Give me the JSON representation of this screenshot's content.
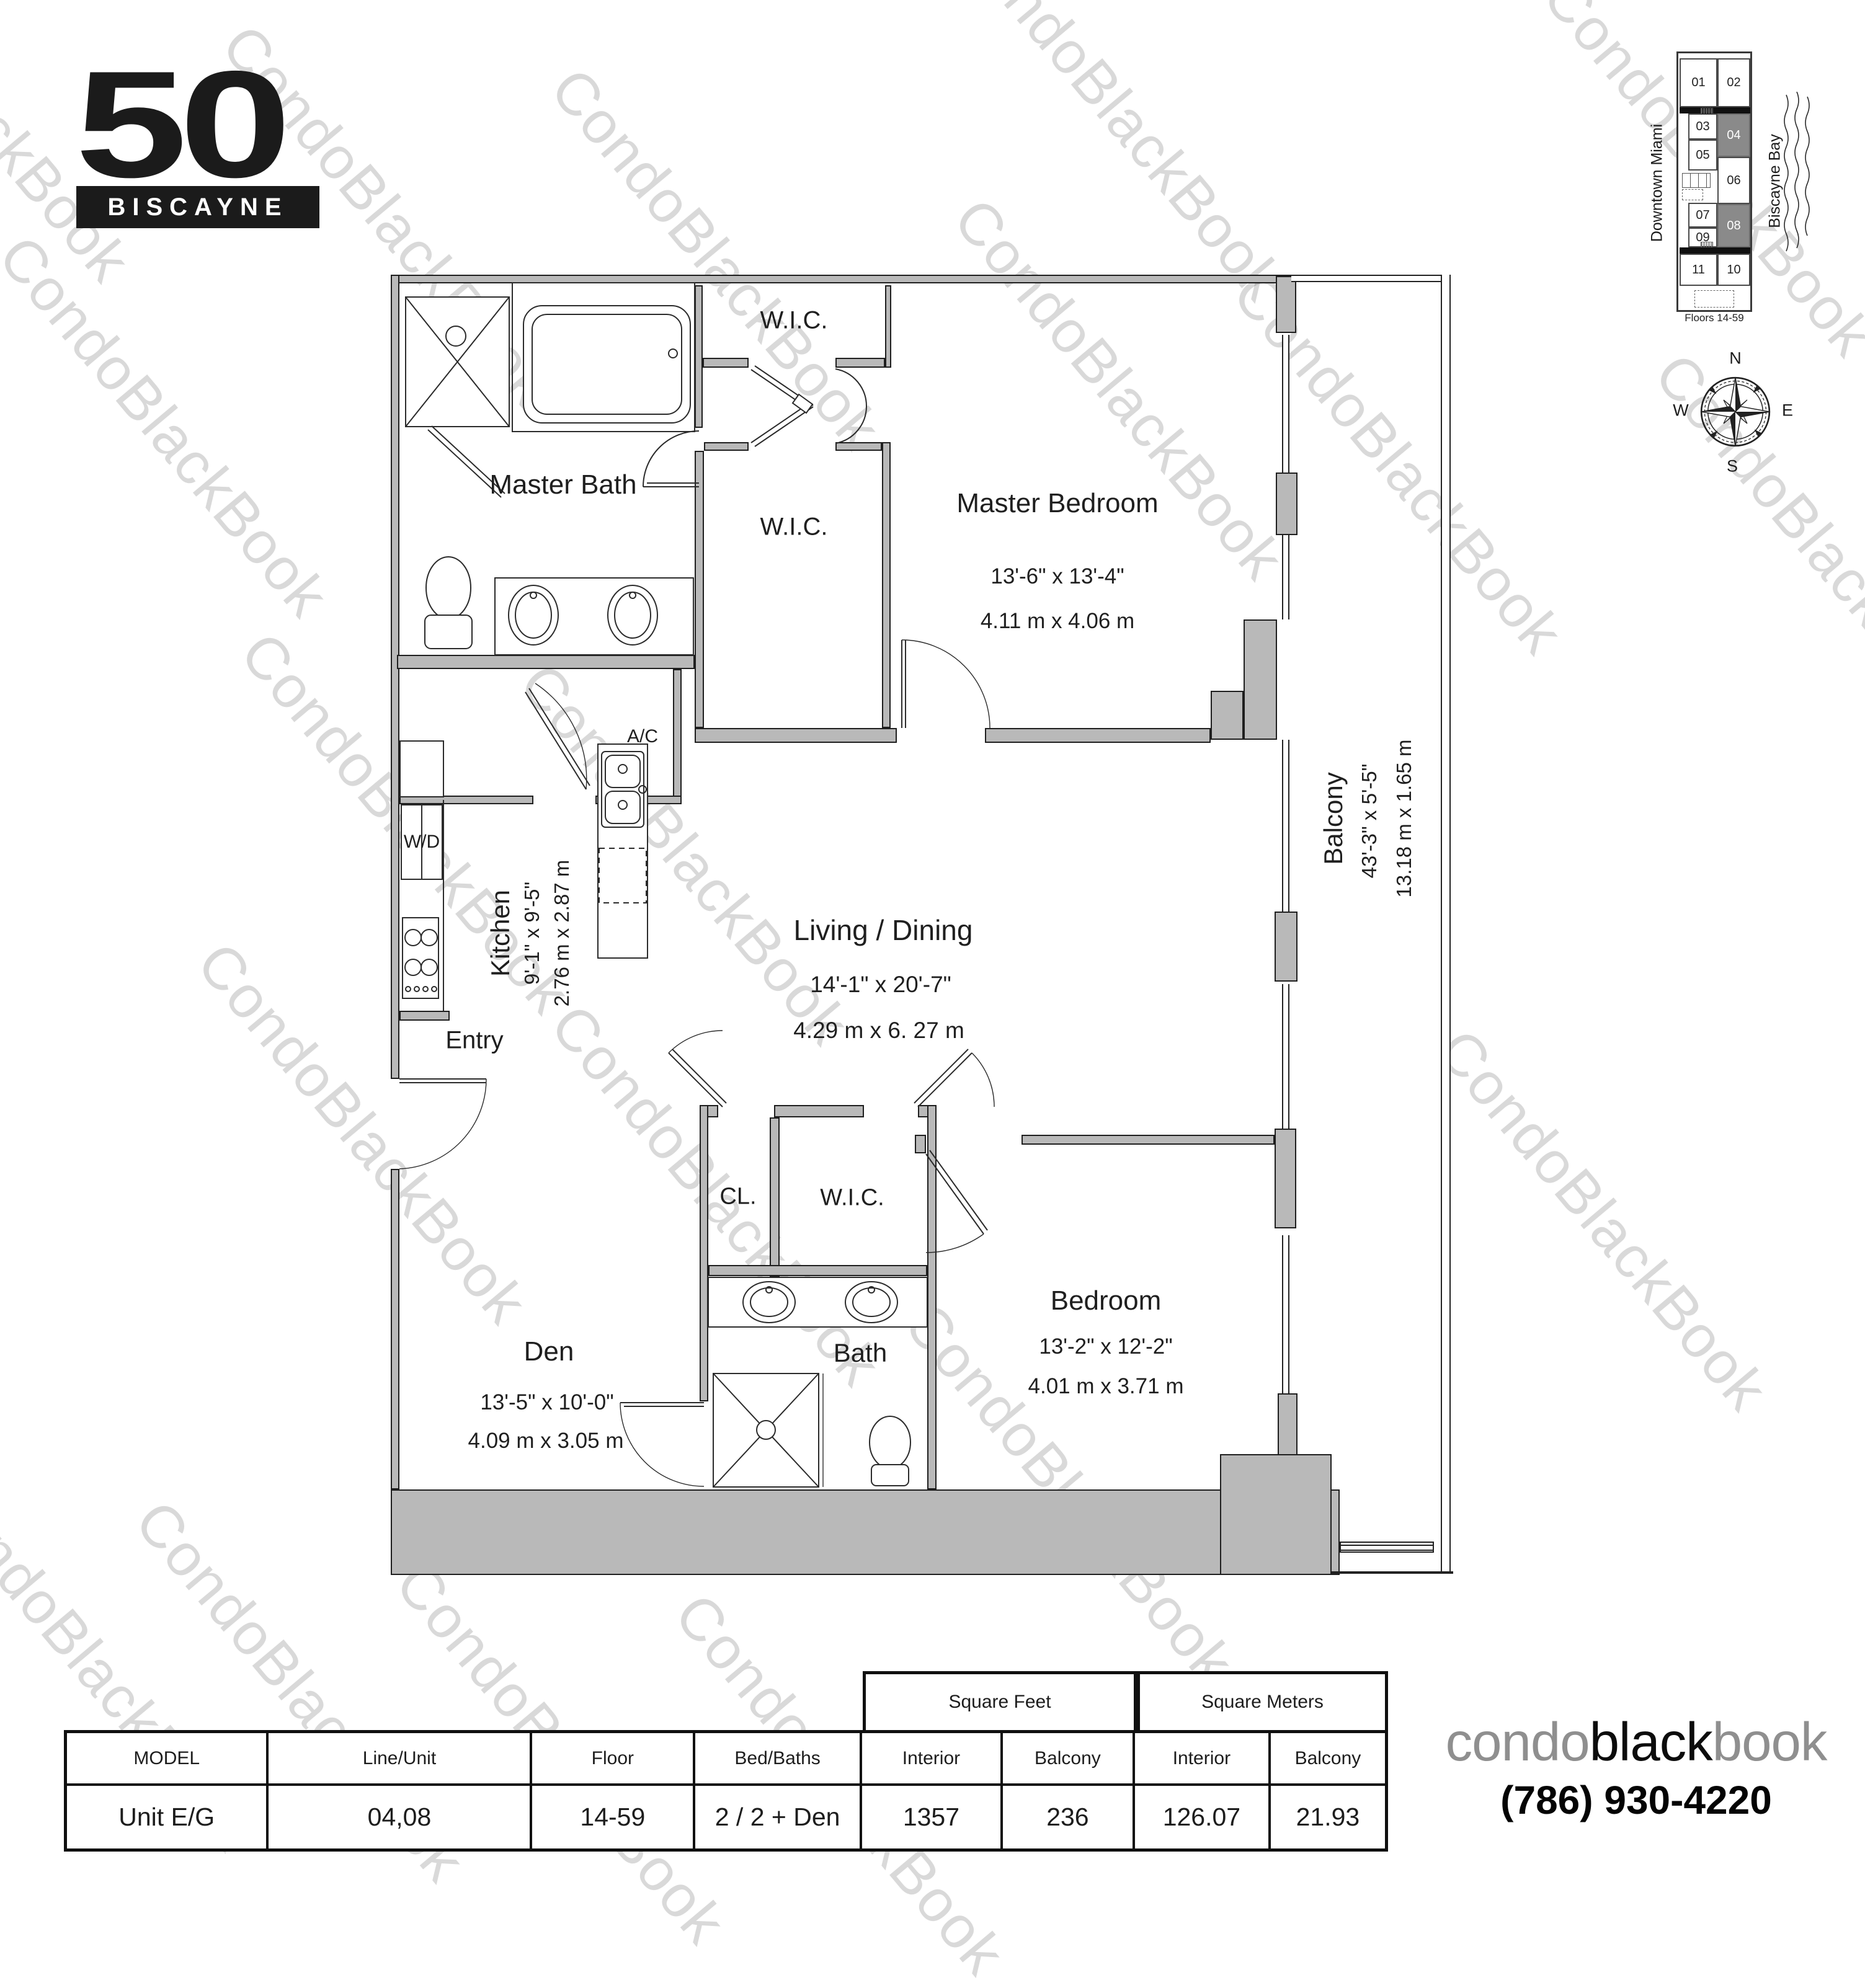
{
  "logo": {
    "number": "50",
    "name": "BISCAYNE"
  },
  "watermark": {
    "text": "CondoBlackBook"
  },
  "keyplan": {
    "units": [
      "01",
      "02",
      "03",
      "04",
      "05",
      "06",
      "07",
      "08",
      "09",
      "10",
      "11"
    ],
    "highlighted_units": [
      "04",
      "08"
    ],
    "left_label": "Downtown Miami",
    "right_label": "Biscayne Bay",
    "caption": "Floors 14-59",
    "compass": {
      "n": "N",
      "s": "S",
      "e": "E",
      "w": "W"
    }
  },
  "rooms": {
    "master_bath": {
      "name": "Master Bath"
    },
    "wic1": {
      "name": "W.I.C."
    },
    "wic2": {
      "name": "W.I.C."
    },
    "master_bedroom": {
      "name": "Master Bedroom",
      "dim_ft": "13'-6\" x 13'-4\"",
      "dim_m": "4.11 m x 4.06 m"
    },
    "wd": {
      "name": "W/D"
    },
    "ac": {
      "name": "A/C"
    },
    "kitchen": {
      "name": "Kitchen",
      "dim_ft": "9'-1\" x 9'-5\"",
      "dim_m": "2.76 m x 2.87 m"
    },
    "living": {
      "name": "Living / Dining",
      "dim_ft": "14'-1\" x 20'-7\"",
      "dim_m": "4.29 m x 6. 27 m"
    },
    "entry": {
      "name": "Entry"
    },
    "den": {
      "name": "Den",
      "dim_ft": "13'-5\" x 10'-0\"",
      "dim_m": "4.09 m x 3.05 m"
    },
    "cl": {
      "name": "CL."
    },
    "wic3": {
      "name": "W.I.C."
    },
    "bath2": {
      "name": "Bath"
    },
    "bedroom2": {
      "name": "Bedroom",
      "dim_ft": "13'-2\" x 12'-2\"",
      "dim_m": "4.01 m x 3.71 m"
    },
    "balcony": {
      "name": "Balcony",
      "dim_ft": "43'-3\" x 5'-5\"",
      "dim_m": "13.18 m x 1.65 m"
    }
  },
  "table": {
    "group_headers": {
      "sqft": "Square Feet",
      "sqm": "Square Meters"
    },
    "columns": [
      "MODEL",
      "Line/Unit",
      "Floor",
      "Bed/Baths",
      "Interior",
      "Balcony",
      "Interior",
      "Balcony"
    ],
    "row": [
      "Unit E/G",
      "04,08",
      "14-59",
      "2 / 2 + Den",
      "1357",
      "236",
      "126.07",
      "21.93"
    ]
  },
  "footer": {
    "brand_part1": "condo",
    "brand_part2": "black",
    "brand_part3": "book",
    "phone": "(786) 930-4220"
  }
}
